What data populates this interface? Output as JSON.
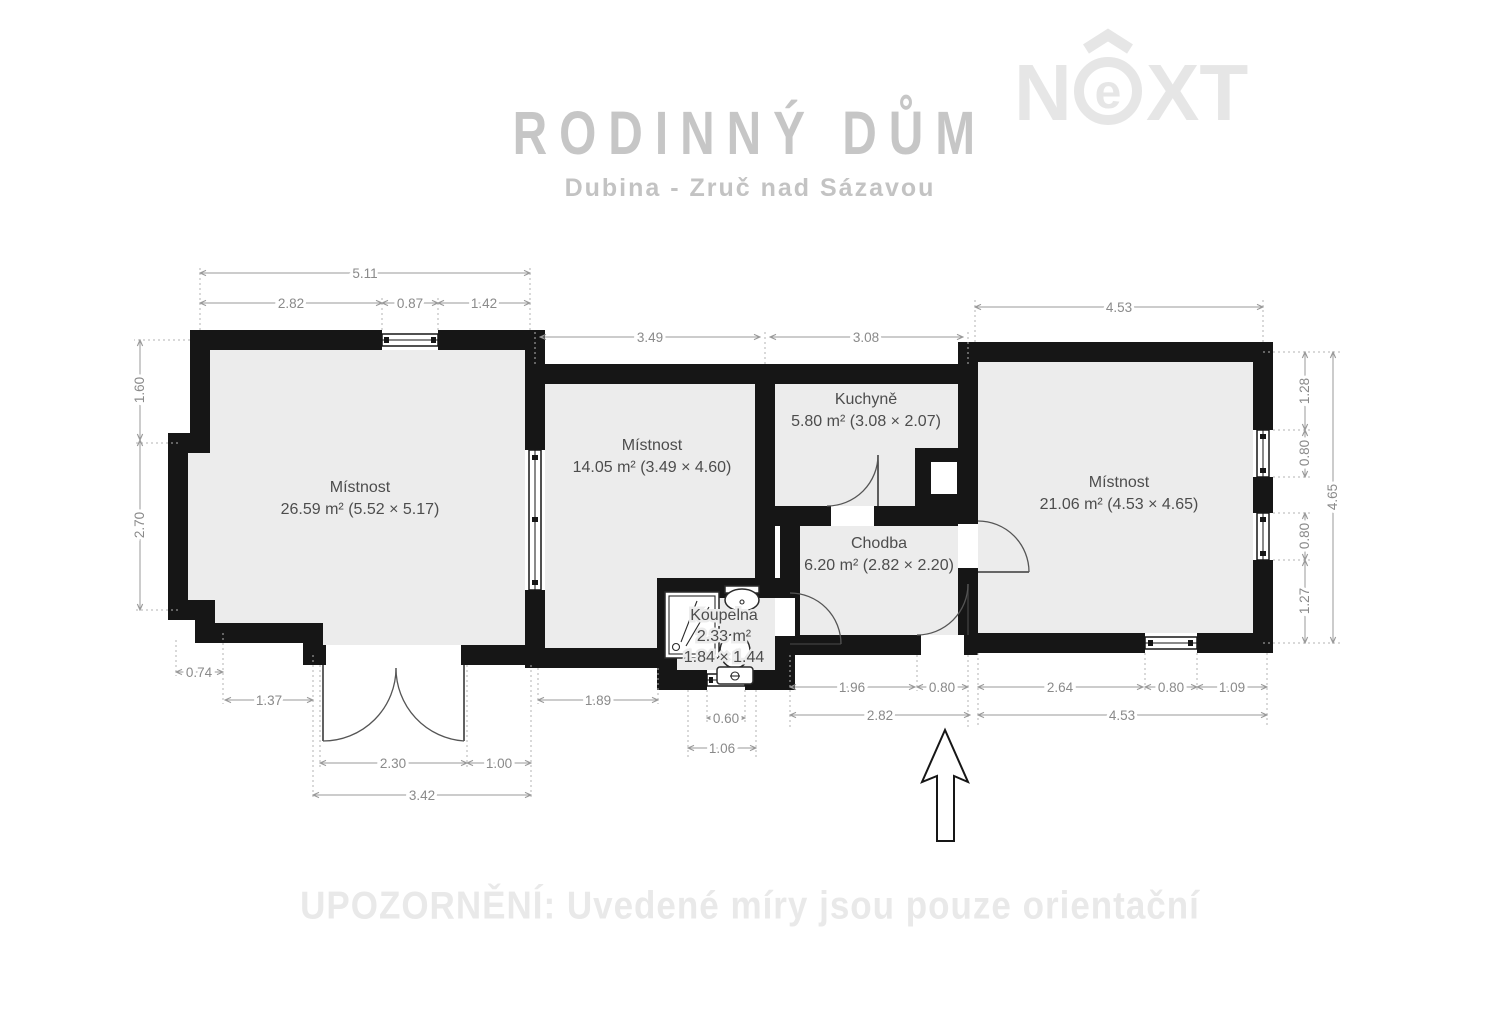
{
  "header": {
    "title": "RODINNÝ DŮM",
    "subtitle": "Dubina - Zruč nad Sázavou"
  },
  "logo": {
    "n": "N",
    "e": "e",
    "xt": "XT"
  },
  "footer": {
    "warning": "UPOZORNĚNÍ: Uvedené míry jsou pouze orientační"
  },
  "plan": {
    "rooms": {
      "room1": {
        "name": "Místnost",
        "details": "26.59 m² (5.52 × 5.17)"
      },
      "room2": {
        "name": "Místnost",
        "details": "14.05 m² (3.49 × 4.60)"
      },
      "kitchen": {
        "name": "Kuchyně",
        "details": "5.80 m² (3.08 × 2.07)"
      },
      "hall": {
        "name": "Chodba",
        "details": "6.20 m² (2.82 × 2.20)"
      },
      "room3": {
        "name": "Místnost",
        "details": "21.06 m² (4.53 × 4.65)"
      },
      "bathroom": {
        "name": "Koupelna",
        "area": "2.33 m²",
        "size": "1.84 × 1.44"
      }
    },
    "dims": {
      "top": {
        "total": "5.11",
        "a": "2.82",
        "window": "0.87",
        "b": "1.42",
        "room2": "3.49",
        "kitchen": "3.08",
        "room3": "4.53"
      },
      "left": {
        "upper": "1.60",
        "lower": "2.70"
      },
      "right": {
        "a": "1.28",
        "win1": "0.80",
        "win2": "0.80",
        "b": "1.27",
        "total": "4.65"
      },
      "bottom_left": {
        "a": "0.74",
        "b": "1.37",
        "door": "2.30",
        "c": "1.00",
        "total": "3.42"
      },
      "bottom_mid": {
        "room2": "1.89",
        "bath_window": "0.60",
        "bath_total": "1.06",
        "hall_a": "1.96",
        "entrance": "0.80",
        "hall_total": "2.82"
      },
      "bottom_right": {
        "a": "2.64",
        "window": "0.80",
        "b": "1.09",
        "total": "4.53"
      }
    }
  }
}
